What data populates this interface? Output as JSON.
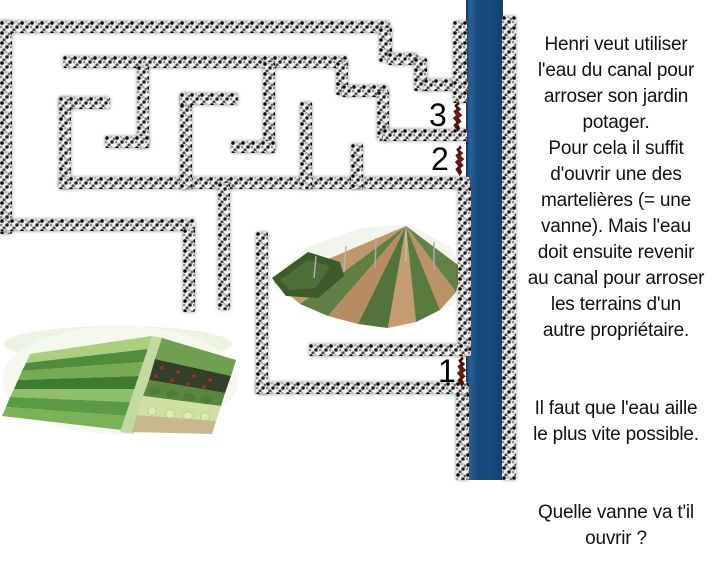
{
  "instructions": {
    "paragraph1": "Henri veut utiliser\nl'eau du canal pour\narroser son jardin\npotager.\nPour cela il suffit\nd'ouvrir une des\nmartelières (= une\nvanne). Mais l'eau\ndoit ensuite revenir\nau canal pour arroser\nles terrains d'un\nautre propriétaire.",
    "paragraph2": "Il faut que l'eau aille\nle plus vite possible.",
    "paragraph3": "Quelle vanne va t'il\nouvrir ?"
  },
  "vannes": [
    {
      "label": "3",
      "num_x": 429,
      "num_y": 99,
      "marker_x": 452,
      "marker_y": 101
    },
    {
      "label": "2",
      "num_x": 431,
      "num_y": 143,
      "marker_x": 454,
      "marker_y": 145
    },
    {
      "label": "1",
      "num_x": 438,
      "num_y": 355,
      "marker_x": 456,
      "marker_y": 356
    }
  ],
  "canal": {
    "color": "#17497c",
    "x": 466,
    "width": 37
  },
  "maze": {
    "walls": [
      {
        "x": 0,
        "y": 21,
        "w": 390,
        "h": 12
      },
      {
        "x": 0,
        "y": 21,
        "w": 12,
        "h": 213
      },
      {
        "x": 379,
        "y": 28,
        "w": 13,
        "h": 34
      },
      {
        "x": 388,
        "y": 53,
        "w": 30,
        "h": 12
      },
      {
        "x": 414,
        "y": 58,
        "w": 13,
        "h": 33
      },
      {
        "x": 424,
        "y": 79,
        "w": 44,
        "h": 12
      },
      {
        "x": 453,
        "y": 21,
        "w": 14,
        "h": 82
      },
      {
        "x": 63,
        "y": 56,
        "w": 284,
        "h": 12
      },
      {
        "x": 336,
        "y": 62,
        "w": 12,
        "h": 33
      },
      {
        "x": 342,
        "y": 85,
        "w": 46,
        "h": 12
      },
      {
        "x": 377,
        "y": 91,
        "w": 12,
        "h": 50
      },
      {
        "x": 383,
        "y": 129,
        "w": 84,
        "h": 12
      },
      {
        "x": 137,
        "y": 66,
        "w": 12,
        "h": 82
      },
      {
        "x": 105,
        "y": 136,
        "w": 44,
        "h": 12
      },
      {
        "x": 59,
        "y": 97,
        "w": 51,
        "h": 12
      },
      {
        "x": 59,
        "y": 97,
        "w": 12,
        "h": 92
      },
      {
        "x": 59,
        "y": 177,
        "w": 411,
        "h": 12
      },
      {
        "x": 180,
        "y": 94,
        "w": 12,
        "h": 95
      },
      {
        "x": 180,
        "y": 93,
        "w": 58,
        "h": 12
      },
      {
        "x": 263,
        "y": 62,
        "w": 12,
        "h": 90
      },
      {
        "x": 231,
        "y": 141,
        "w": 44,
        "h": 12
      },
      {
        "x": 300,
        "y": 102,
        "w": 12,
        "h": 87
      },
      {
        "x": 351,
        "y": 144,
        "w": 12,
        "h": 45
      },
      {
        "x": 0,
        "y": 219,
        "w": 195,
        "h": 12
      },
      {
        "x": 183,
        "y": 229,
        "w": 12,
        "h": 83
      },
      {
        "x": 218,
        "y": 183,
        "w": 12,
        "h": 127
      },
      {
        "x": 458,
        "y": 187,
        "w": 13,
        "h": 169
      },
      {
        "x": 309,
        "y": 344,
        "w": 159,
        "h": 12
      },
      {
        "x": 456,
        "y": 383,
        "w": 13,
        "h": 97
      },
      {
        "x": 256,
        "y": 382,
        "w": 212,
        "h": 12
      },
      {
        "x": 256,
        "y": 232,
        "w": 12,
        "h": 162
      },
      {
        "x": 502,
        "y": 16,
        "w": 14,
        "h": 464
      }
    ]
  }
}
